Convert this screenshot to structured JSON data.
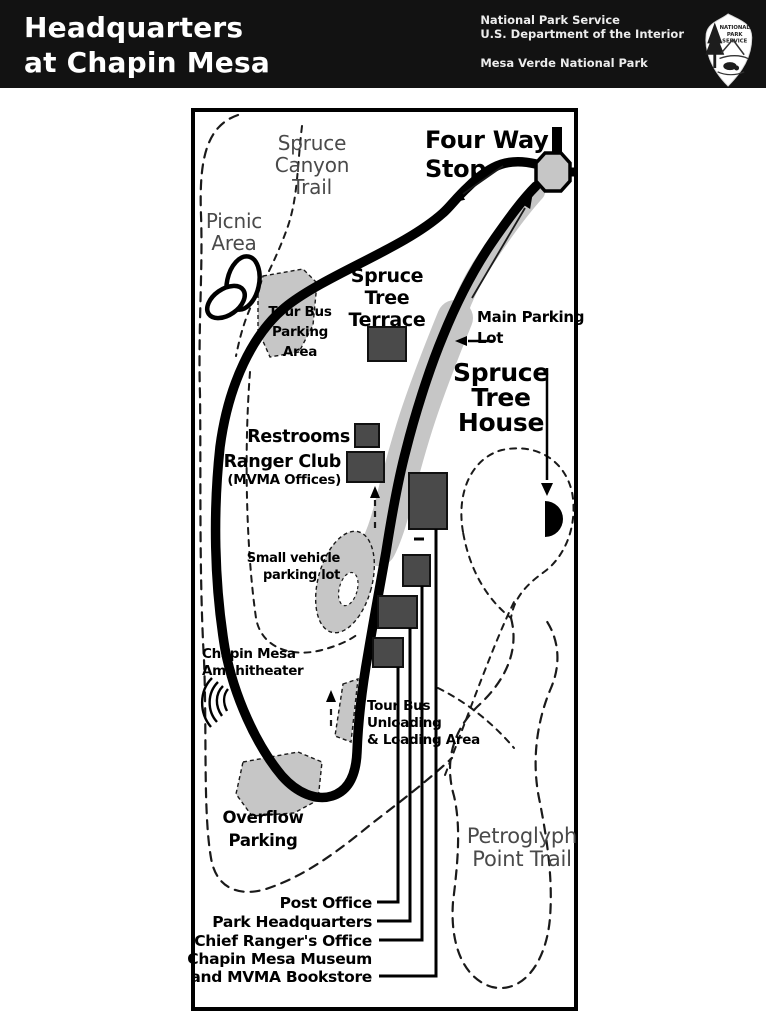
{
  "header": {
    "title_line1": "Headquarters",
    "title_line2": "at Chapin Mesa",
    "agency_line1": "National Park Service",
    "agency_line2": "U.S. Department of the Interior",
    "park_name": "Mesa Verde National Park",
    "logo_text": [
      "NATIONAL",
      "PARK",
      "SERVICE"
    ]
  },
  "map": {
    "labels": {
      "four_way_stop": [
        "Four Way",
        "Stop"
      ],
      "spruce_canyon_trail": [
        "Spruce",
        "Canyon",
        "Trail"
      ],
      "picnic_area": [
        "Picnic",
        "Area"
      ],
      "tour_bus_parking": [
        "Tour Bus",
        "Parking",
        "Area"
      ],
      "spruce_tree_terrace": [
        "Spruce",
        "Tree",
        "Terrace"
      ],
      "main_parking_lot": [
        "Main Parking",
        "Lot"
      ],
      "spruce_tree_house": [
        "Spruce",
        "Tree",
        "House"
      ],
      "restrooms": "Restrooms",
      "ranger_club": "Ranger Club",
      "ranger_club_sub": "(MVMA Offices)",
      "small_vehicle_lot": [
        "Small vehicle",
        "parking lot"
      ],
      "chapin_mesa_amphitheater": [
        "Chapin Mesa",
        "Amphitheater"
      ],
      "tour_bus_unloading": [
        "Tour Bus",
        "Unloading",
        "& Loading Area"
      ],
      "overflow_parking": [
        "Overflow",
        "Parking"
      ],
      "petroglyph_point_trail": [
        "Petroglyph",
        "Point Trail"
      ],
      "post_office": "Post Office",
      "park_headquarters": "Park Headquarters",
      "chief_rangers_office": "Chief Ranger's Office",
      "museum_line1": "Chapin Mesa Museum",
      "museum_line2": "and MVMA Bookstore"
    },
    "colors": {
      "header_bg": "#121212",
      "road": "#000000",
      "parking_gray": "#c6c6c6",
      "building_gray": "#4a4a4a",
      "trail_label_gray": "#4a4a4a"
    }
  }
}
